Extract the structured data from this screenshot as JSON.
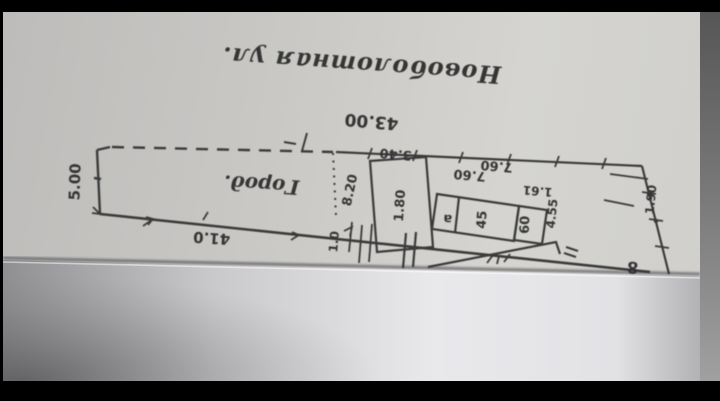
{
  "photo": {
    "description_title": "Новоболотная ул.",
    "plot": {
      "top_width": "43.00",
      "left_depth": "5.00",
      "frontage": "41.0",
      "area_label": "Город.",
      "divider_dim": "1.0"
    },
    "buildings": {
      "shed1_top": "3.40",
      "shed1_left": "8.20",
      "shed1_inside": "1.80",
      "shed2_top_left": "7.60",
      "shed2_top_right": "7.60",
      "shed2_letter": "а",
      "shed2_mid": "45",
      "shed2_box": "60",
      "annex_top": "1.61",
      "annex_side": "4.55"
    },
    "right_boundary": {
      "dim": "1.90",
      "corner_mark": "8"
    },
    "colors": {
      "ink": "#3a3a3a",
      "upper_sheet": "#cac9c6",
      "lower_sheet": "#e9e9ec"
    }
  }
}
